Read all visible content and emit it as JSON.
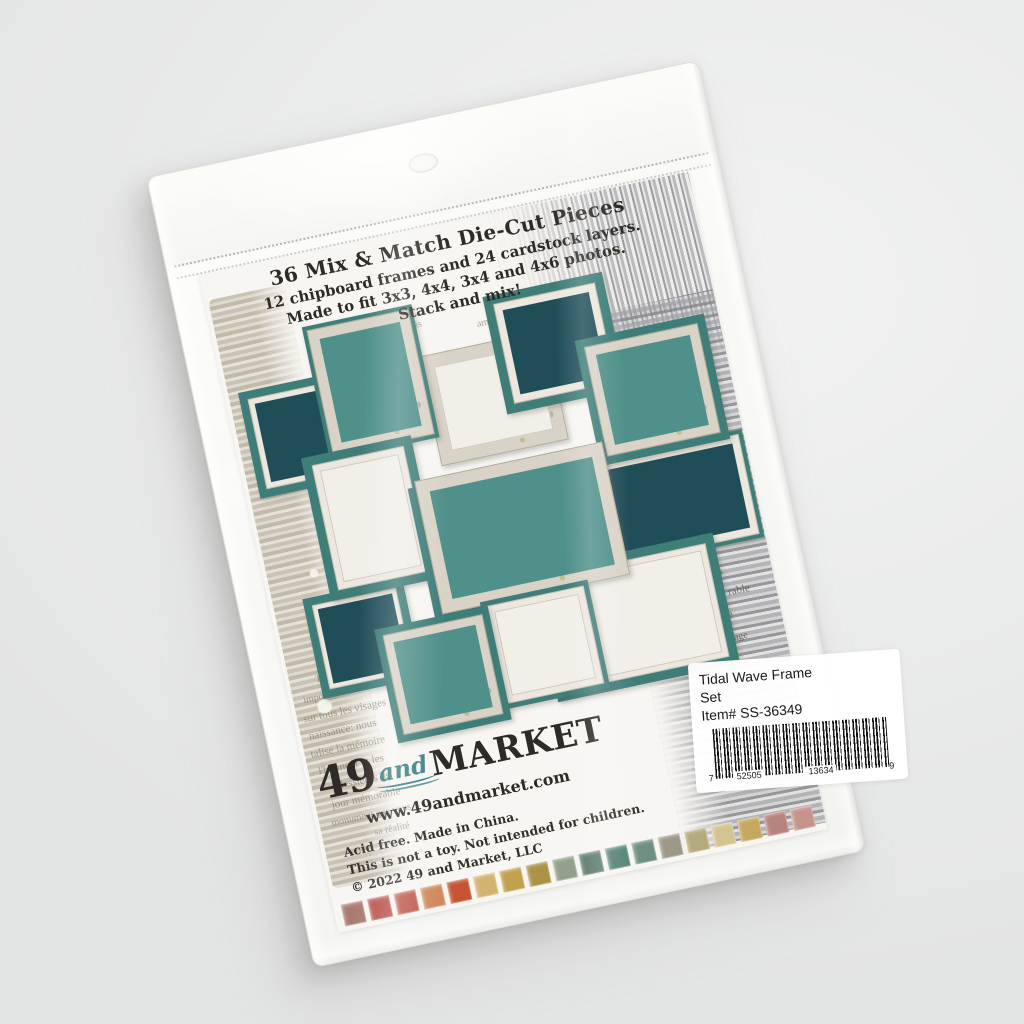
{
  "package": {
    "header": {
      "line1": "36 Mix & Match Die-Cut Pieces",
      "line2": "12 chipboard frames and 24 cardstock layers.",
      "line3": "Made to fit 3x3, 4x4, 3x4 and 4x6 photos.",
      "line4": "Stack and mix!"
    },
    "logo": {
      "num": "49",
      "and": "and",
      "market": "MARKET",
      "url": "www.49andmarket.com"
    },
    "fine_print": {
      "line1": "Acid free. Made in China.",
      "line2": "This is not a toy. Not intended for children.",
      "line3": "© 2022 49 and Market, LLC"
    },
    "label": {
      "title_line1": "Tidal Wave Frame",
      "title_line2": "Set",
      "item": "Item# SS-36349",
      "barcode_digits": [
        "7",
        "52505",
        "13634",
        "9"
      ]
    },
    "background_text": [
      "a de nouve",
      "bonheur",
      "depuis",
      "amour",
      "août 18",
      "ter i se delte de",
      "nous",
      "rable",
      "que",
      "orage",
      "Tr",
      "importants les",
      "sur tous les visages",
      "naissance: nous",
      "talise la mémoire",
      "l'honneur et les",
      "Messieurs les",
      "jour mémorable",
      "monument que vous",
      "sa réalité"
    ],
    "swatches": [
      "#aa7b71",
      "#b94e48",
      "#c05c51",
      "#d08a5e",
      "#c65431",
      "#d2b36f",
      "#c2a14e",
      "#aa9346",
      "#92a28a",
      "#5d7b6d",
      "#517f72",
      "#6f8f82",
      "#9e9886",
      "#b3ab7c",
      "#d3c492",
      "#c5a75f",
      "#b8837a",
      "#c6948c"
    ],
    "colors": {
      "teal": "#4f908a",
      "tealBorder": "#3f7d79",
      "darkTeal": "#204e58",
      "cream": "#f2efe9",
      "mat": "#d9d3c7",
      "ink": "#2e2a26",
      "logoTeal": "#3e7f85",
      "beige": "#c6beae",
      "gray": "#97999e"
    }
  }
}
